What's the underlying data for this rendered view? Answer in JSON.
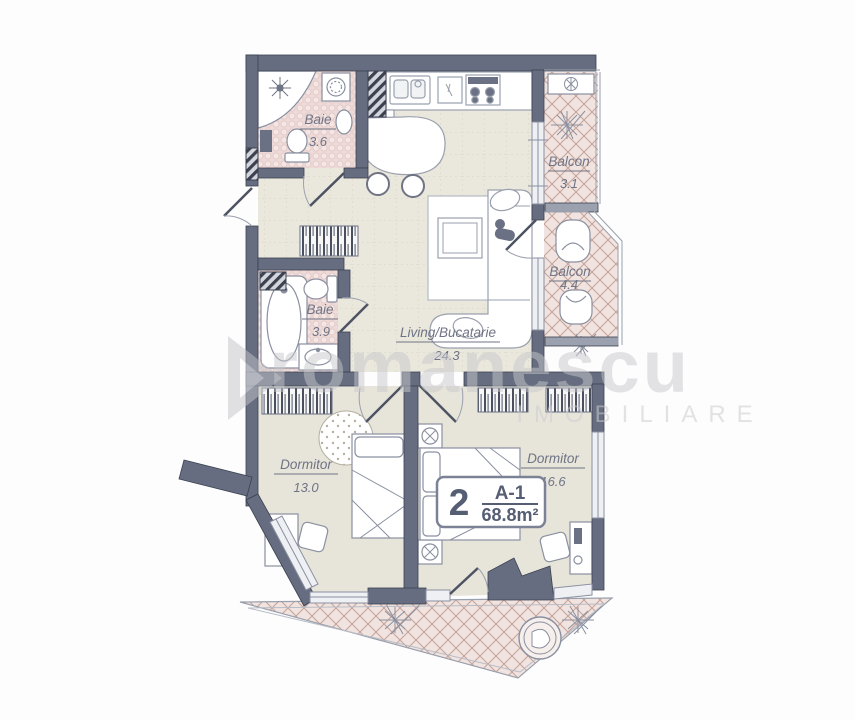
{
  "plan": {
    "rooms": {
      "baie1": {
        "name": "Baie",
        "area": "3.6"
      },
      "baie2": {
        "name": "Baie",
        "area": "3.9"
      },
      "living": {
        "name": "Living/Bucatarie",
        "area": "24.3"
      },
      "balcon1": {
        "name": "Balcon",
        "area": "3.1"
      },
      "balcon2": {
        "name": "Balcon",
        "area": "4.4"
      },
      "dorm1": {
        "name": "Dormitor",
        "area": "13.0"
      },
      "dorm2": {
        "name": "Dormitor",
        "area": "16.6"
      }
    },
    "badge": {
      "rooms": "2",
      "unit": "A-1",
      "area": "68.8m²"
    },
    "watermark": {
      "line1": "romanescu",
      "line2": "IMOBILIARE"
    },
    "colors": {
      "wall": "#666d80",
      "wall_light": "#9ba1ae",
      "floor": "#eae7dc",
      "bath_floor": "#eedad8",
      "balcony_floor": "#f1e4e0",
      "label": "#6f7485",
      "badge_text": "#565e74"
    }
  }
}
